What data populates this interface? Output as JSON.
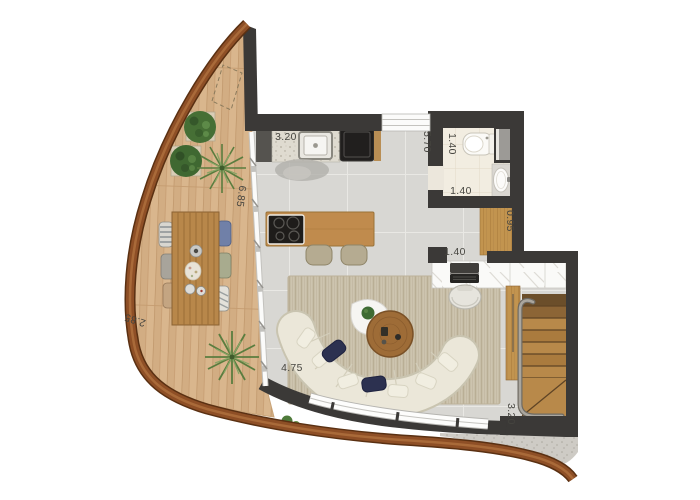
{
  "plan": {
    "type": "apartment-floor-plan",
    "dimension_labels": {
      "kitchen_counter_width": "3.20",
      "kitchen_living_depth": "5.70",
      "bathroom_depth": "1.40",
      "bathroom_width": "1.40",
      "hallway_width": "0.95",
      "desk_nook_width": "1.40",
      "deck_length": "6.85",
      "deck_width": "2.85",
      "living_room_width": "4.75",
      "stair_area_depth": "3.20"
    },
    "palette": {
      "exterior_band": "#8e4f26",
      "interior_walls": "#3b3937",
      "deck_wood": "#d9b68d",
      "floor_tile": "#d8d7d3",
      "bath_floor": "#f2ede1",
      "rug": "#cdc4af",
      "sofa": "#ebe7d9",
      "accent_pillow": "#2c3150",
      "furniture_wood": "#c08b4d",
      "label_text": "#45443f"
    }
  }
}
